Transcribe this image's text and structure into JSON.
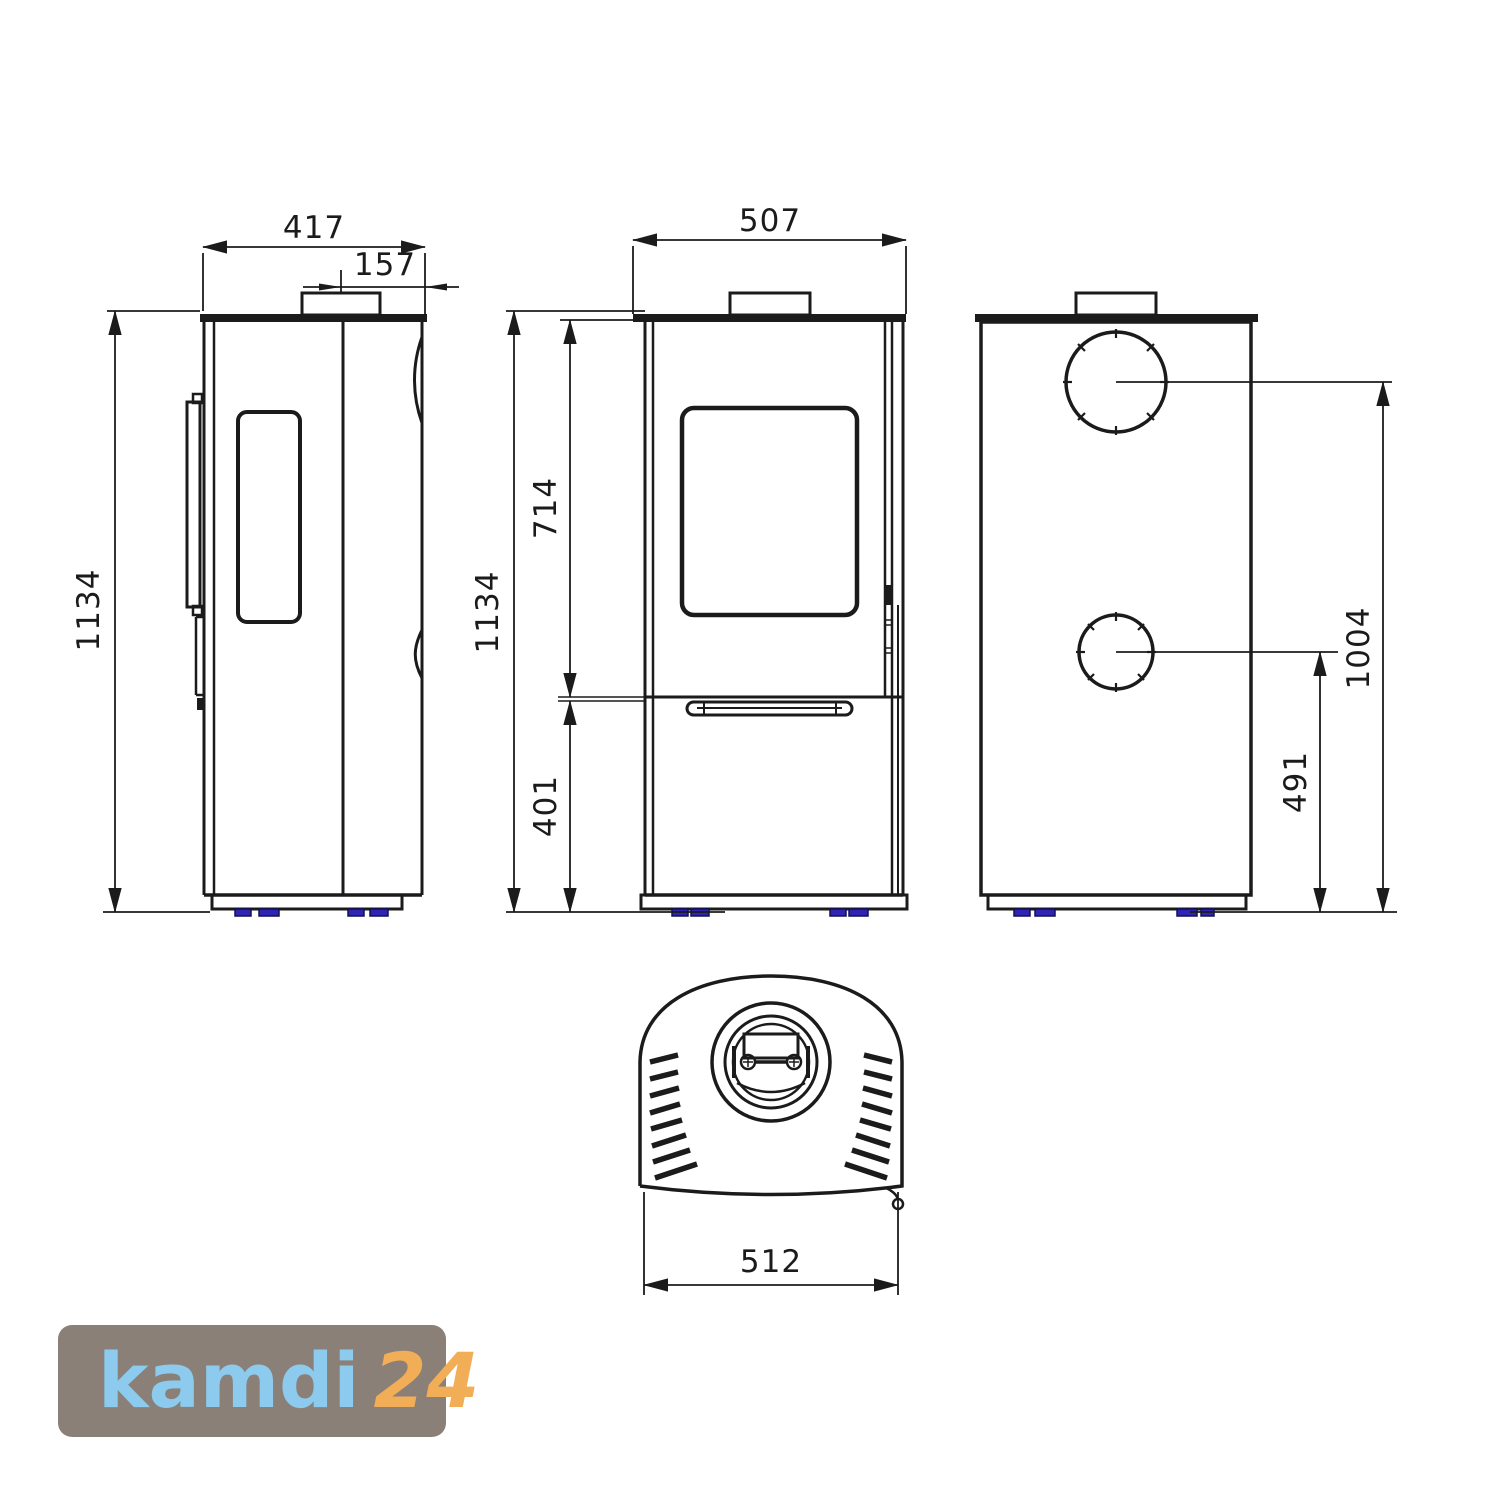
{
  "drawing": {
    "background": "#ffffff",
    "line_color": "#1b1b1b",
    "feet_color": "#2e25b4"
  },
  "dimensions": {
    "side_depth": "417",
    "flue_offset": "157",
    "height": "1134",
    "front_width": "507",
    "upper_height": "714",
    "lower_height": "401",
    "rear_upper_flue": "1004",
    "rear_lower_flue": "491",
    "top_depth": "512"
  },
  "logo": {
    "brand": "kamdi",
    "suffix": "24",
    "background": "#8a8078",
    "brand_color": "#8dcbee",
    "suffix_color": "#f2ad57"
  }
}
